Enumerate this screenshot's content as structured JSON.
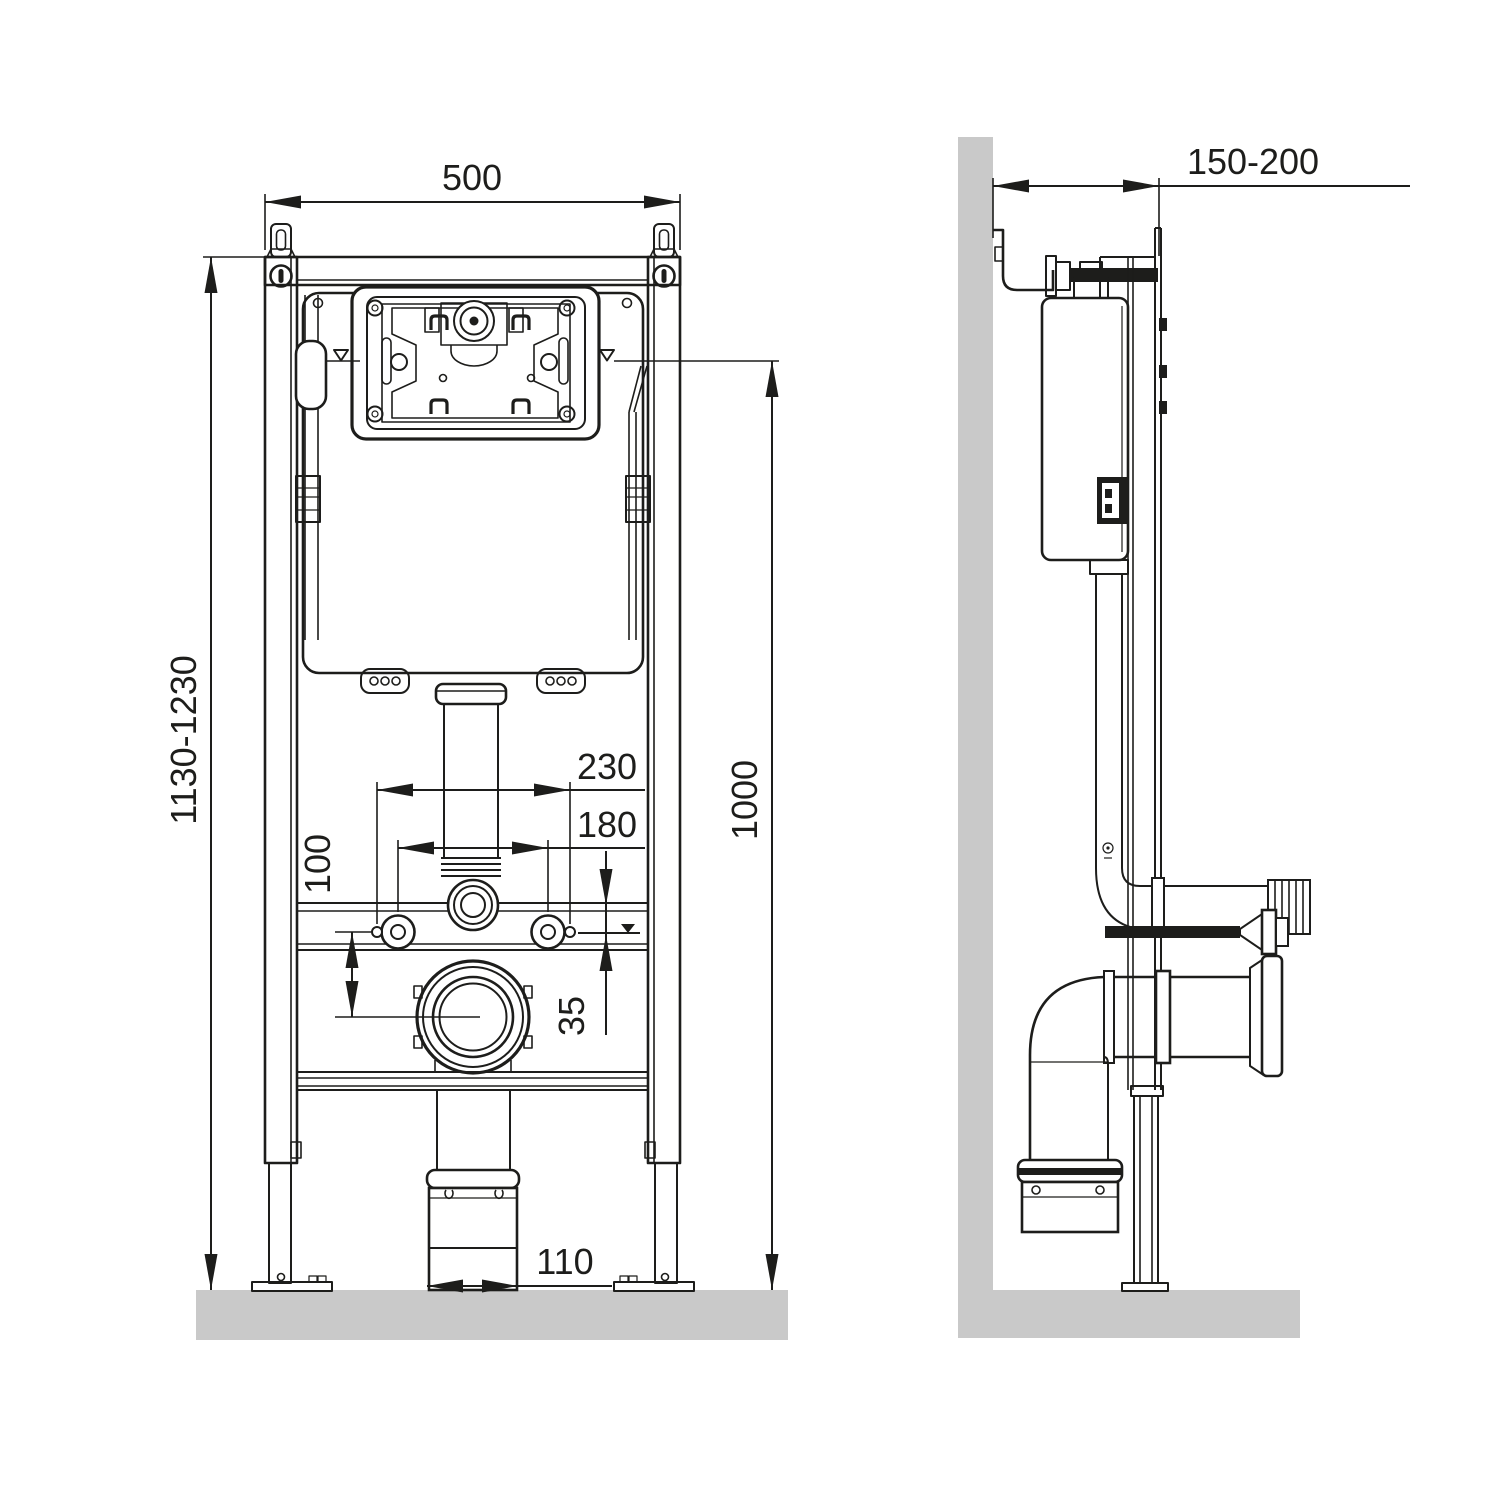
{
  "diagram": {
    "type": "technical-drawing",
    "subject": "wall-hung WC concealed cistern installation frame, front and side views",
    "dimensions": {
      "frame_width": "500",
      "frame_height_range": "1130-1230",
      "flush_connection_height": "1000",
      "upper_fixing_spacing": "230",
      "pan_fixing_spacing": "180",
      "drain_center_offset": "100",
      "level_offset": "35",
      "drain_outlet_width": "110",
      "wall_distance_range": "150-200"
    },
    "colors": {
      "line": "#1d1d1b",
      "wall_fill": "#c9c9c9",
      "background": "#ffffff"
    }
  }
}
